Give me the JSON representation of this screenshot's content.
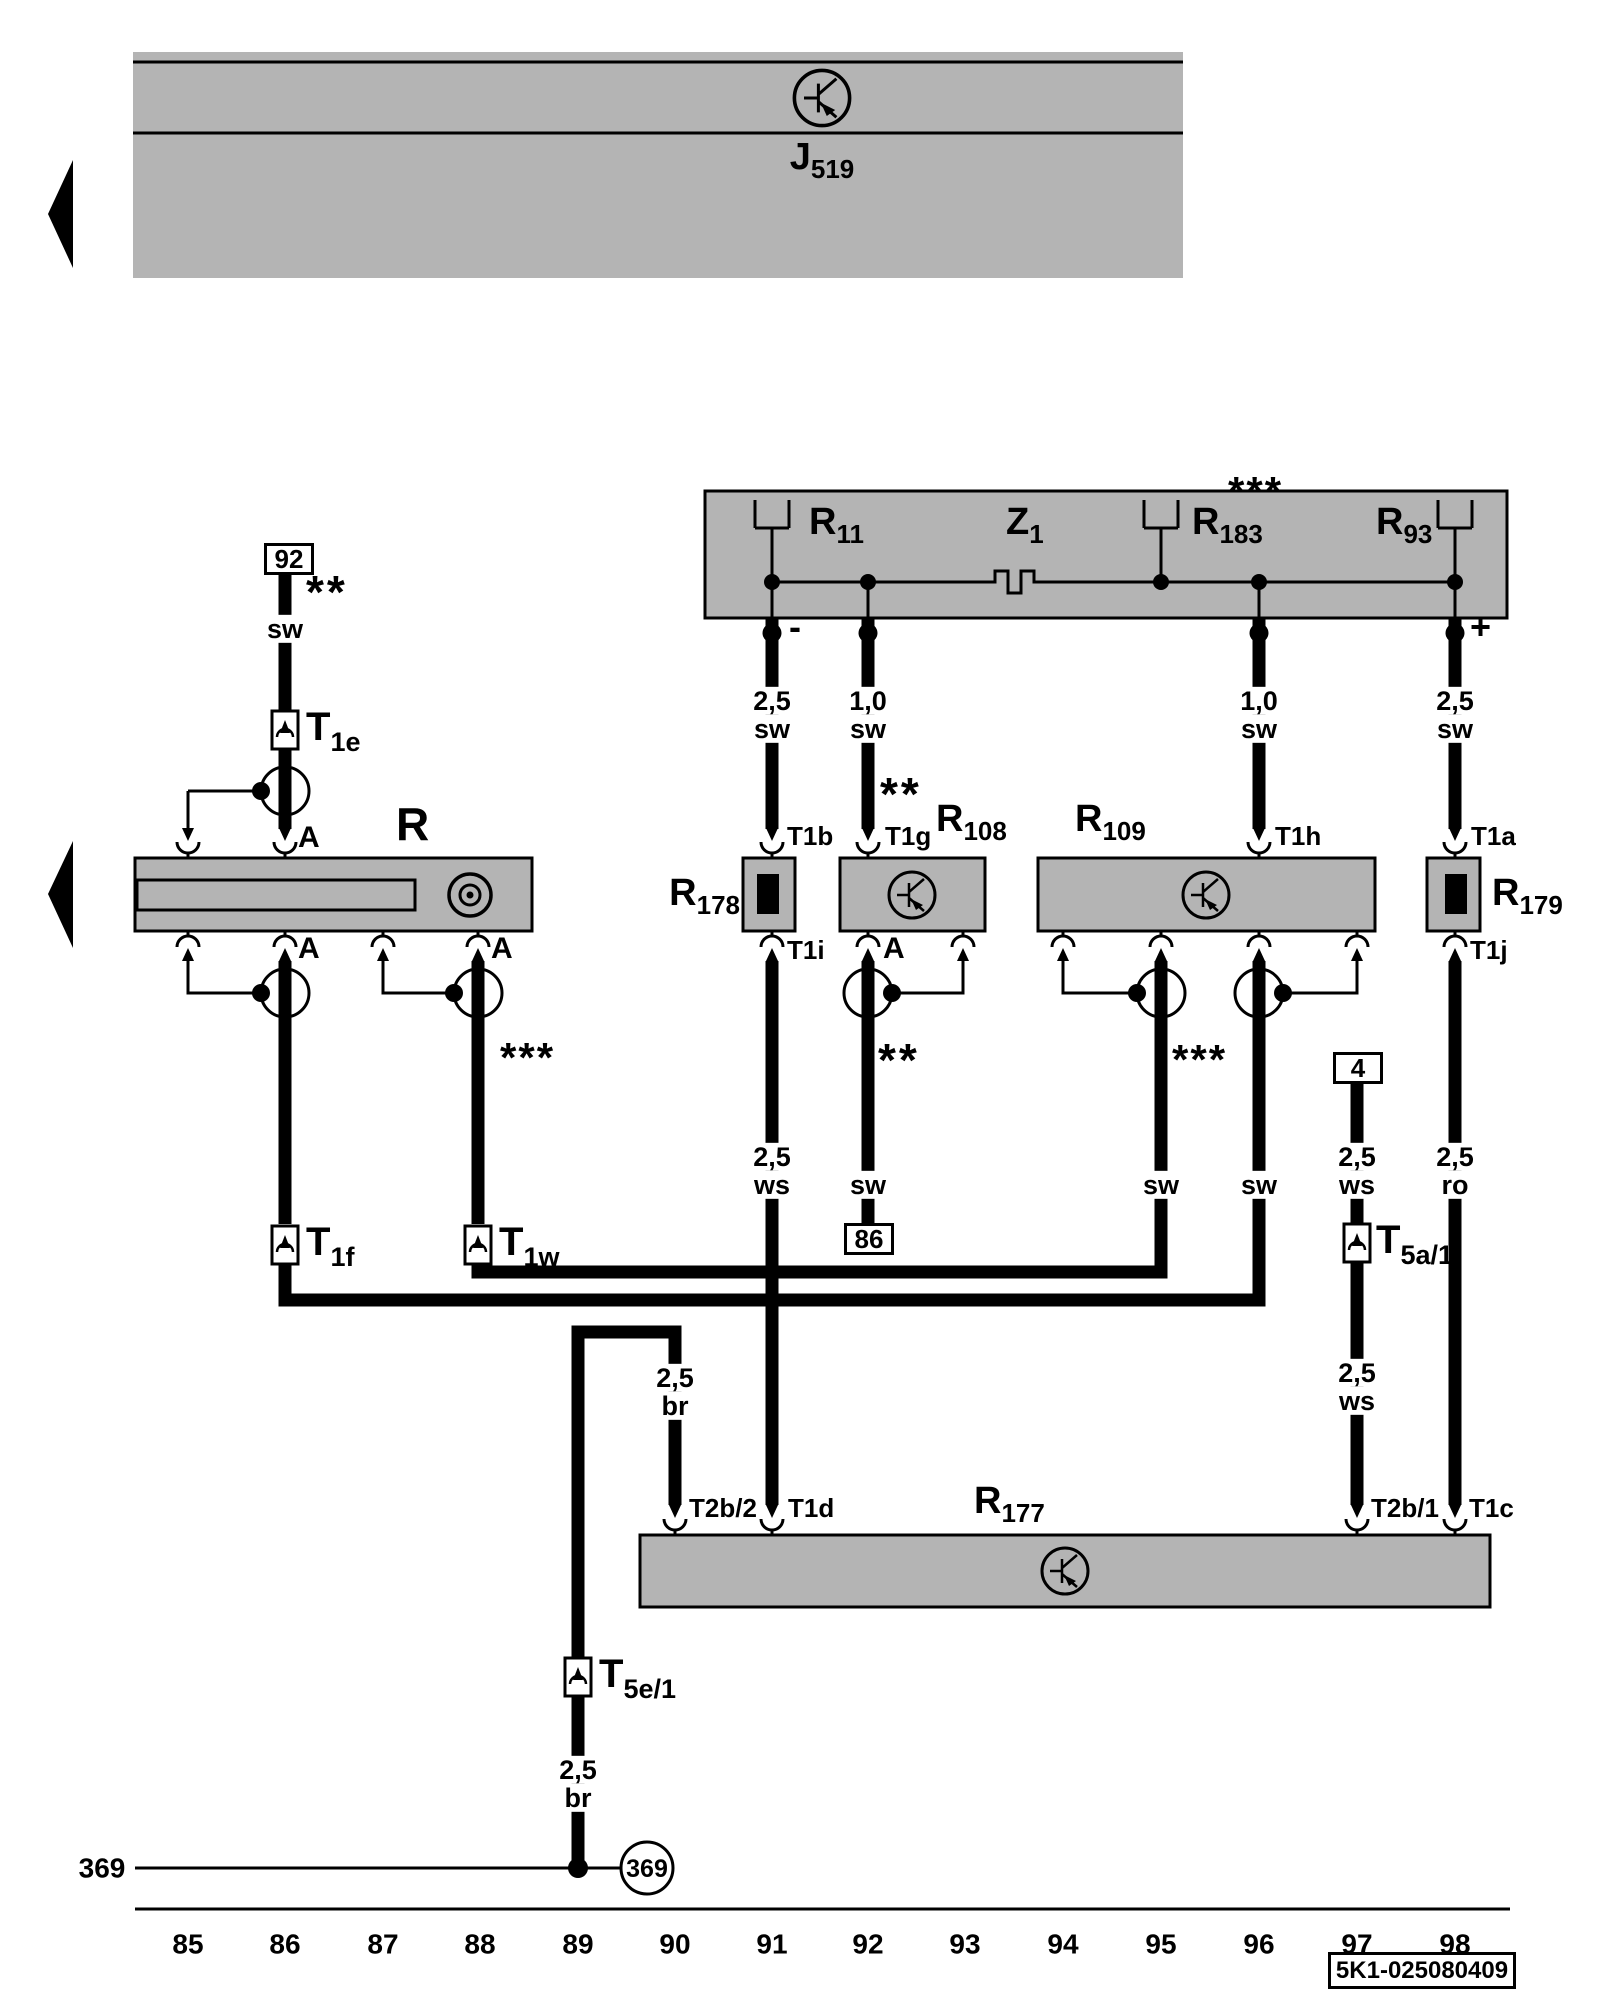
{
  "colors": {
    "module_fill": "#b4b4b4",
    "line": "#000000",
    "background": "#ffffff",
    "wire": "#000000"
  },
  "header": {
    "module": {
      "main": "J",
      "sub": "519"
    }
  },
  "antenna_module": {
    "r11": {
      "main": "R",
      "sub": "11"
    },
    "z1": {
      "main": "Z",
      "sub": "1"
    },
    "r183": {
      "main": "R",
      "sub": "183"
    },
    "r93": {
      "main": "R",
      "sub": "93"
    },
    "minus": "-",
    "plus": "+"
  },
  "components": {
    "radio": {
      "label": "R"
    },
    "r178": {
      "main": "R",
      "sub": "178"
    },
    "r108": {
      "main": "R",
      "sub": "108"
    },
    "r109": {
      "main": "R",
      "sub": "109"
    },
    "r179": {
      "main": "R",
      "sub": "179"
    },
    "r177": {
      "main": "R",
      "sub": "177"
    }
  },
  "connectors": {
    "c92": "92",
    "c86": "86",
    "c4": "4",
    "t1e": {
      "main": "T",
      "sub": "1e"
    },
    "t1f": {
      "main": "T",
      "sub": "1f"
    },
    "t1w": {
      "main": "T",
      "sub": "1w"
    },
    "t5a1": {
      "main": "T",
      "sub": "5a/1"
    },
    "t5e1": {
      "main": "T",
      "sub": "5e/1"
    }
  },
  "terminals": {
    "t1a": "T1a",
    "t1b": "T1b",
    "t1c": "T1c",
    "t1d": "T1d",
    "t1g": "T1g",
    "t1h": "T1h",
    "t1i": "T1i",
    "t1j": "T1j",
    "t2b1": "T2b/1",
    "t2b2": "T2b/2",
    "a": "A"
  },
  "wires": {
    "w86": {
      "color": "sw"
    },
    "w91_top": {
      "gauge": "2,5",
      "color": "sw"
    },
    "w92_top": {
      "gauge": "1,0",
      "color": "sw"
    },
    "w96_top": {
      "gauge": "1,0",
      "color": "sw"
    },
    "w98_top": {
      "gauge": "2,5",
      "color": "sw"
    },
    "w91_mid": {
      "gauge": "2,5",
      "color": "ws"
    },
    "w92_mid": {
      "color": "sw"
    },
    "w95_mid": {
      "color": "sw"
    },
    "w96_mid": {
      "color": "sw"
    },
    "w97_mid": {
      "gauge": "2,5",
      "color": "ws"
    },
    "w97_low": {
      "gauge": "2,5",
      "color": "ws"
    },
    "w98_mid": {
      "gauge": "2,5",
      "color": "ro"
    },
    "br_upper": {
      "gauge": "2,5",
      "color": "br"
    },
    "br_lower": {
      "gauge": "2,5",
      "color": "br"
    }
  },
  "notes": {
    "two_star": "**",
    "three_star": "***"
  },
  "ground": {
    "label": "369"
  },
  "footer": {
    "tracks": [
      "85",
      "86",
      "87",
      "88",
      "89",
      "90",
      "91",
      "92",
      "93",
      "94",
      "95",
      "96",
      "97",
      "98"
    ],
    "diagram_id": "5K1-025080409"
  }
}
